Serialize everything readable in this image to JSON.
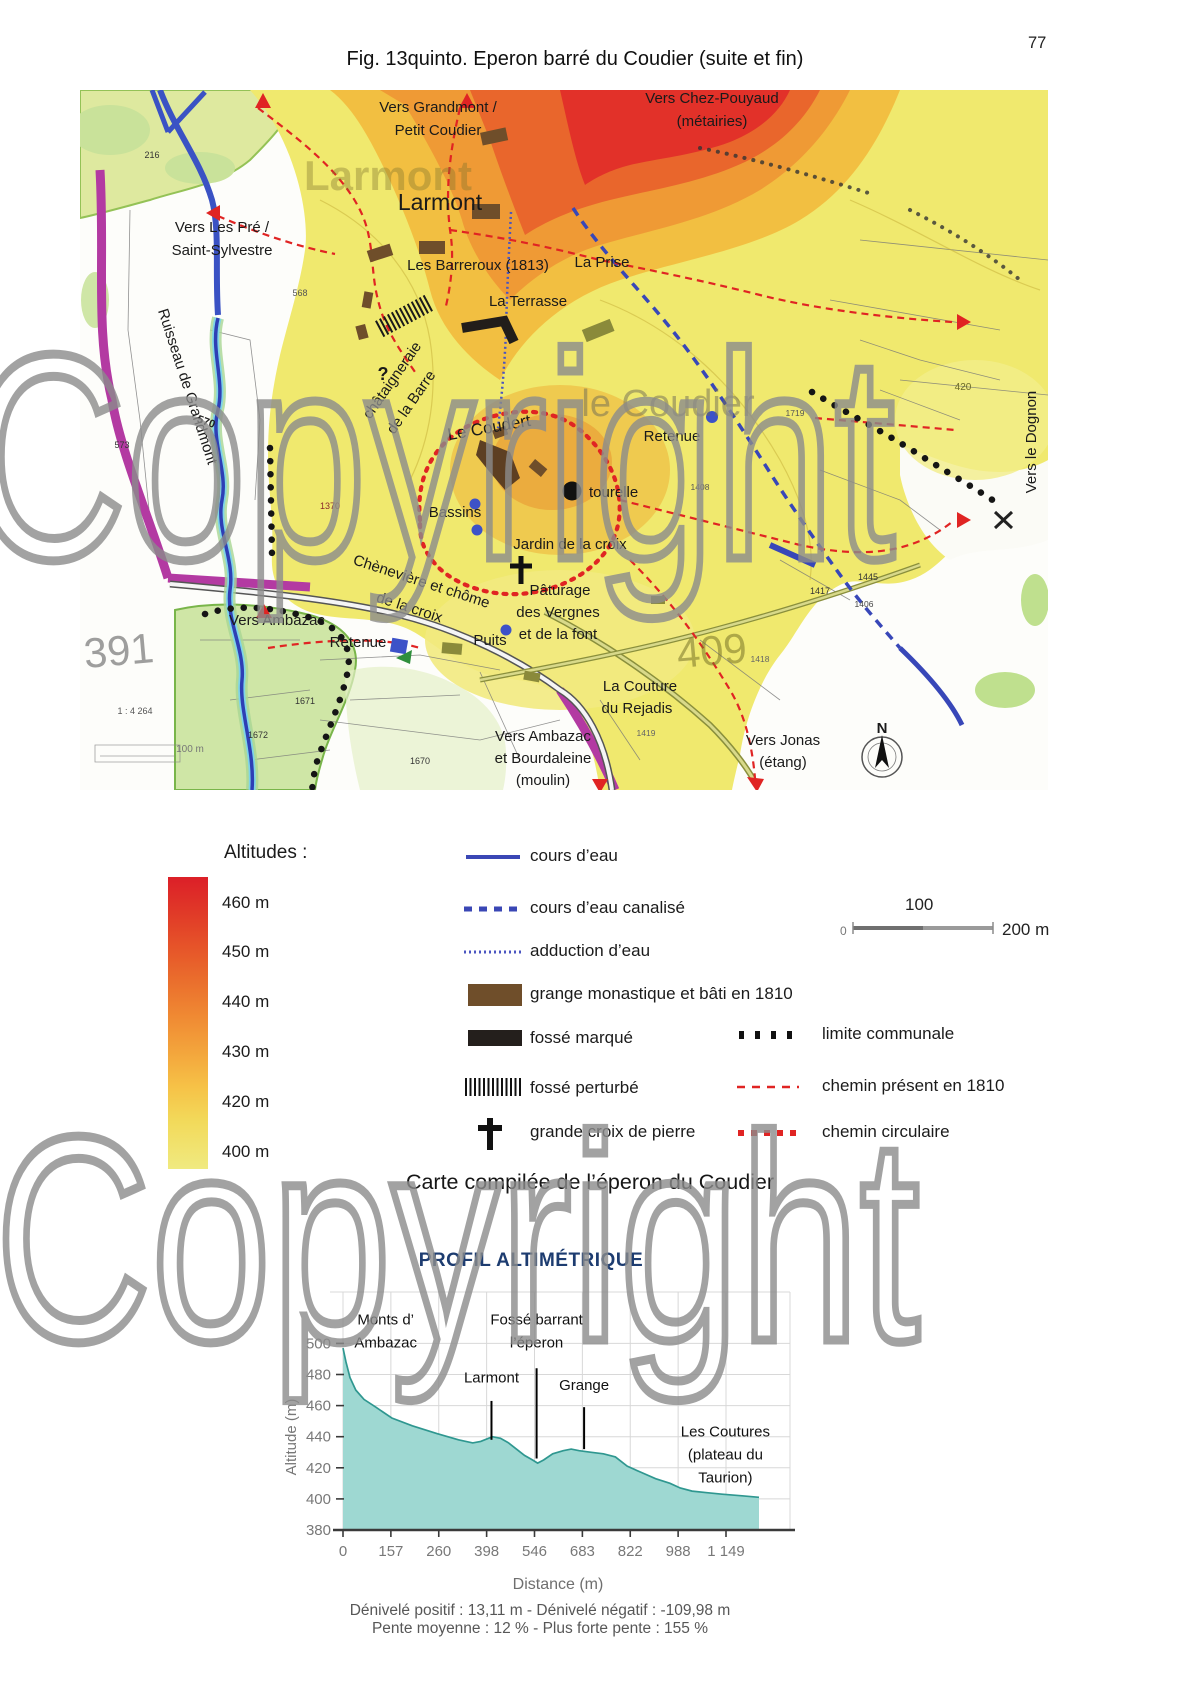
{
  "page": {
    "number": "77",
    "title": "Fig. 13quinto. Eperon barré du Coudier (suite et fin)",
    "caption": "Carte compilée de l’éperon du Coudier",
    "watermark": "Copyright"
  },
  "map": {
    "labels": [
      {
        "t": "Vers Grandmont /",
        "x": 438,
        "y": 112,
        "s": 15
      },
      {
        "t": "Petit Coudier",
        "x": 438,
        "y": 135,
        "s": 15
      },
      {
        "t": "Vers Chez-Pouyaud",
        "x": 712,
        "y": 103,
        "s": 15
      },
      {
        "t": "(métairies)",
        "x": 712,
        "y": 126,
        "s": 15
      },
      {
        "t": "Larmont",
        "x": 388,
        "y": 190,
        "s": 42,
        "c": "rgba(125,115,45,0.38)",
        "w": "bold"
      },
      {
        "t": "Larmont",
        "x": 440,
        "y": 210,
        "s": 23
      },
      {
        "t": "Les Barreroux (1813)",
        "x": 478,
        "y": 270,
        "s": 15
      },
      {
        "t": "La Prise",
        "x": 602,
        "y": 267,
        "s": 15
      },
      {
        "t": "La Terrasse",
        "x": 528,
        "y": 306,
        "s": 15
      },
      {
        "t": "Vers Les Pré /",
        "x": 222,
        "y": 232,
        "s": 15
      },
      {
        "t": "Saint-Sylvestre",
        "x": 222,
        "y": 255,
        "s": 15
      },
      {
        "t": "Ruisseau de Grandmont",
        "x": 183,
        "y": 388,
        "s": 15,
        "r": 72
      },
      {
        "t": "châtaigneraie",
        "x": 396,
        "y": 383,
        "s": 15,
        "r": -55
      },
      {
        "t": "de la Barre",
        "x": 415,
        "y": 405,
        "s": 15,
        "r": -55
      },
      {
        "t": "?",
        "x": 383,
        "y": 380,
        "s": 18,
        "w": "bold"
      },
      {
        "t": "Le Coudert",
        "x": 490,
        "y": 433,
        "s": 17,
        "r": -10
      },
      {
        "t": "le Coudier",
        "x": 668,
        "y": 416,
        "s": 38,
        "c": "rgba(110,105,85,0.5)"
      },
      {
        "t": "Retenue",
        "x": 672,
        "y": 441,
        "s": 15
      },
      {
        "t": "Vers le Dognon",
        "x": 1036,
        "y": 442,
        "s": 15,
        "r": -90
      },
      {
        "t": "(châtellenie)",
        "x": 1059,
        "y": 442,
        "s": 15,
        "r": -90
      },
      {
        "t": "tourelle",
        "x": 589,
        "y": 497,
        "s": 15,
        "a": "start"
      },
      {
        "t": "Bassins",
        "x": 455,
        "y": 517,
        "s": 15
      },
      {
        "t": "Jardin de la croix",
        "x": 570,
        "y": 549,
        "s": 15
      },
      {
        "t": "Chènevière et chôme",
        "x": 420,
        "y": 586,
        "s": 15,
        "r": 18
      },
      {
        "t": "de la croix",
        "x": 408,
        "y": 612,
        "s": 15,
        "r": 18
      },
      {
        "t": "Pâturage",
        "x": 560,
        "y": 595,
        "s": 15
      },
      {
        "t": "des Vergnes",
        "x": 558,
        "y": 617,
        "s": 15
      },
      {
        "t": "et de la font",
        "x": 558,
        "y": 639,
        "s": 15
      },
      {
        "t": "Vers Ambazac",
        "x": 277,
        "y": 625,
        "s": 15
      },
      {
        "t": "Retenue",
        "x": 358,
        "y": 647,
        "s": 15
      },
      {
        "t": "Puits",
        "x": 490,
        "y": 645,
        "s": 15
      },
      {
        "t": "La Couture",
        "x": 640,
        "y": 691,
        "s": 15
      },
      {
        "t": "du Rejadis",
        "x": 637,
        "y": 713,
        "s": 15
      },
      {
        "t": "Vers Ambazac",
        "x": 543,
        "y": 741,
        "s": 15
      },
      {
        "t": "et Bourdaleine",
        "x": 543,
        "y": 763,
        "s": 15
      },
      {
        "t": "(moulin)",
        "x": 543,
        "y": 785,
        "s": 15
      },
      {
        "t": "Vers Jonas",
        "x": 783,
        "y": 745,
        "s": 15
      },
      {
        "t": "(étang)",
        "x": 783,
        "y": 767,
        "s": 15
      },
      {
        "t": "391",
        "x": 120,
        "y": 665,
        "s": 42,
        "c": "rgba(80,80,80,0.55)",
        "r": -5
      },
      {
        "t": "409",
        "x": 713,
        "y": 665,
        "s": 42,
        "c": "rgba(120,115,40,0.55)",
        "r": -5
      },
      {
        "t": "N",
        "x": 882,
        "y": 733,
        "s": 15,
        "w": "bold"
      },
      {
        "t": "216",
        "x": 152,
        "y": 158,
        "s": 9,
        "c": "#333"
      },
      {
        "t": "568",
        "x": 300,
        "y": 296,
        "s": 9,
        "c": "#555"
      },
      {
        "t": "573",
        "x": 122,
        "y": 448,
        "s": 9,
        "c": "#333"
      },
      {
        "t": "570",
        "x": 205,
        "y": 425,
        "s": 11,
        "c": "#222",
        "w": "bold",
        "r": 20
      },
      {
        "t": "1370",
        "x": 330,
        "y": 509,
        "s": 9,
        "c": "#8a2a2a"
      },
      {
        "t": "420",
        "x": 963,
        "y": 390,
        "s": 10,
        "c": "#6b6b2a"
      },
      {
        "t": "1719",
        "x": 795,
        "y": 416,
        "s": 8.5,
        "c": "#555"
      },
      {
        "t": "1408",
        "x": 700,
        "y": 490,
        "s": 8.5,
        "c": "#555"
      },
      {
        "t": "1417",
        "x": 820,
        "y": 594,
        "s": 9,
        "c": "#333"
      },
      {
        "t": "1445",
        "x": 868,
        "y": 580,
        "s": 9,
        "c": "#333"
      },
      {
        "t": "1406",
        "x": 864,
        "y": 607,
        "s": 8.5,
        "c": "#444"
      },
      {
        "t": "1418",
        "x": 760,
        "y": 662,
        "s": 8.5,
        "c": "#666"
      },
      {
        "t": "1419",
        "x": 646,
        "y": 736,
        "s": 8.5,
        "c": "#666"
      },
      {
        "t": "1671",
        "x": 305,
        "y": 704,
        "s": 9,
        "c": "#333"
      },
      {
        "t": "1672",
        "x": 258,
        "y": 738,
        "s": 9,
        "c": "#333"
      },
      {
        "t": "1670",
        "x": 420,
        "y": 764,
        "s": 9,
        "c": "#333"
      },
      {
        "t": "1 : 4 264",
        "x": 135,
        "y": 714,
        "s": 9,
        "c": "#555"
      },
      {
        "t": "100 m",
        "x": 190,
        "y": 752,
        "s": 10,
        "c": "#777"
      }
    ]
  },
  "legend": {
    "altitudes_title": "Altitudes :",
    "altitude_labels": [
      "460 m",
      "450 m",
      "440 m",
      "430 m",
      "420 m",
      "400 m"
    ],
    "altitude_colors": [
      "#dc1f28",
      "#e65429",
      "#f08a33",
      "#f3a53c",
      "#f6c247",
      "#f0ea80"
    ],
    "symbols_left": [
      {
        "key": "cours-eau",
        "label": "cours d’eau"
      },
      {
        "key": "cours-eau-canalise",
        "label": "cours d’eau canalisé"
      },
      {
        "key": "adduction-eau",
        "label": "adduction d’eau"
      },
      {
        "key": "grange",
        "label": "grange monastique et bâti en 1810"
      },
      {
        "key": "fosse-marque",
        "label": "fossé marqué"
      },
      {
        "key": "fosse-perturbe",
        "label": "fossé perturbé"
      },
      {
        "key": "grande-croix",
        "label": "grande croix de pierre"
      }
    ],
    "symbols_right": [
      {
        "key": "limite-communale",
        "label": "limite communale"
      },
      {
        "key": "chemin-1810",
        "label": "chemin présent en 1810"
      },
      {
        "key": "chemin-circulaire",
        "label": "chemin circulaire"
      }
    ],
    "scale_bar": {
      "zero": "0",
      "hundred": "100",
      "two_hundred": "200 m"
    },
    "colors": {
      "water": "#3a47b5",
      "grange": "#6f4e2a",
      "black": "#1f1b18",
      "red": "#e02423"
    }
  },
  "chart_data": {
    "type": "area",
    "title": "PROFIL ALTIMÉTRIQUE",
    "xlabel": "Distance (m)",
    "ylabel": "Altitude (m)",
    "x_ticks": [
      0,
      157,
      260,
      398,
      546,
      683,
      822,
      988,
      1149
    ],
    "x_tick_labels": [
      "0",
      "157",
      "260",
      "398",
      "546",
      "683",
      "822",
      "988",
      "1 149"
    ],
    "y_ticks": [
      500,
      480,
      460,
      440,
      420,
      400,
      380
    ],
    "ylim": [
      380,
      500
    ],
    "grid": true,
    "fill_color": "#9ed8d2",
    "line_color": "#2f9790",
    "series": [
      [
        0,
        497
      ],
      [
        10,
        488
      ],
      [
        23,
        478
      ],
      [
        42,
        470
      ],
      [
        69,
        464
      ],
      [
        108,
        459
      ],
      [
        159,
        452
      ],
      [
        203,
        447
      ],
      [
        256,
        442
      ],
      [
        317,
        438
      ],
      [
        358,
        436
      ],
      [
        381,
        437
      ],
      [
        416,
        440
      ],
      [
        441,
        439
      ],
      [
        466,
        436
      ],
      [
        490,
        432
      ],
      [
        515,
        428
      ],
      [
        540,
        425
      ],
      [
        555,
        423
      ],
      [
        572,
        425
      ],
      [
        598,
        429
      ],
      [
        628,
        431
      ],
      [
        651,
        432
      ],
      [
        674,
        431
      ],
      [
        709,
        430
      ],
      [
        744,
        429
      ],
      [
        779,
        427
      ],
      [
        813,
        421
      ],
      [
        861,
        417
      ],
      [
        910,
        413
      ],
      [
        960,
        410
      ],
      [
        995,
        407
      ],
      [
        1035,
        405
      ],
      [
        1085,
        404
      ],
      [
        1136,
        403
      ],
      [
        1203,
        402
      ],
      [
        1260,
        401
      ]
    ],
    "annotations": [
      {
        "lines": [
          "Monts d’",
          "Ambazac"
        ],
        "d": 140,
        "label_alt": 512
      },
      {
        "lines": [
          "Fossé barrant",
          "l’éperon"
        ],
        "d": 552,
        "label_alt": 512,
        "marker": {
          "top_alt": 484,
          "bottom_alt": 426
        }
      },
      {
        "lines": [
          "Larmont"
        ],
        "d": 413,
        "label_alt": 475,
        "marker": {
          "top_alt": 463,
          "bottom_alt": 438
        }
      },
      {
        "lines": [
          "Grange"
        ],
        "d": 688,
        "label_alt": 470,
        "marker": {
          "top_alt": 459,
          "bottom_alt": 432
        }
      },
      {
        "lines": [
          "Les Coutures",
          "(plateau du",
          "Taurion)"
        ],
        "d": 1147,
        "label_alt": 440
      }
    ],
    "footer1": "Dénivelé positif : 13,11 m - Dénivelé négatif : -109,98 m",
    "footer2": "Pente moyenne : 12 % - Plus forte pente : 155 %"
  }
}
